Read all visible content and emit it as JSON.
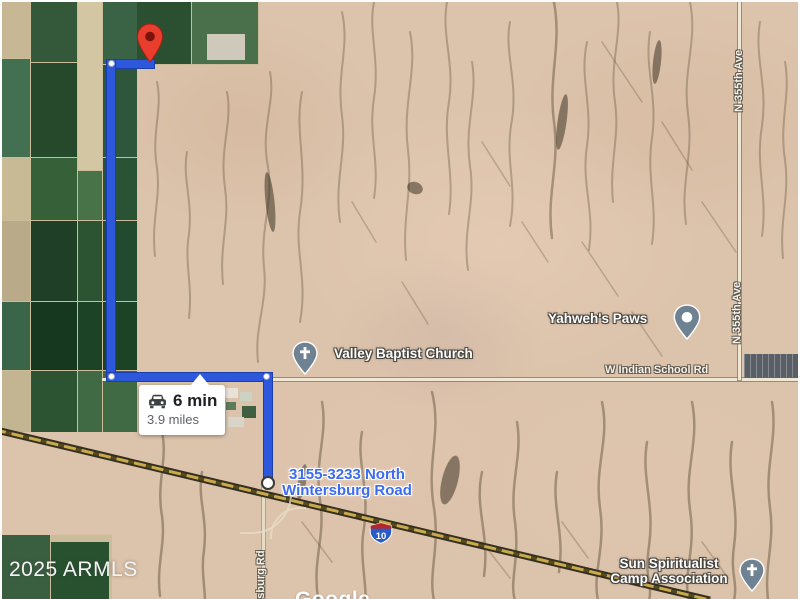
{
  "route_info": {
    "duration": "6 min",
    "distance": "3.9 miles"
  },
  "destination": {
    "line1": "3155-3233 North",
    "line2": "Wintersburg Road"
  },
  "pois": {
    "church": "Valley Baptist Church",
    "paws": "Yahweh's Paws",
    "camp_line1": "Sun Spiritualist",
    "camp_line2": "Camp Association"
  },
  "roads": {
    "indian_school": "W Indian School Rd",
    "ave_355": "N 355th Ave",
    "wintersburg_partial": "rsburg Rd",
    "interstate_number": "10"
  },
  "watermarks": {
    "attribution": "2025 ARMLS",
    "logo": "Google"
  },
  "colors": {
    "route_blue": "#2d58dc",
    "destination_text": "#3b6cf0",
    "start_pin_red": "#e93d2e",
    "poi_pin_slate": "#6f8292",
    "desert": "#dcc3ab"
  }
}
